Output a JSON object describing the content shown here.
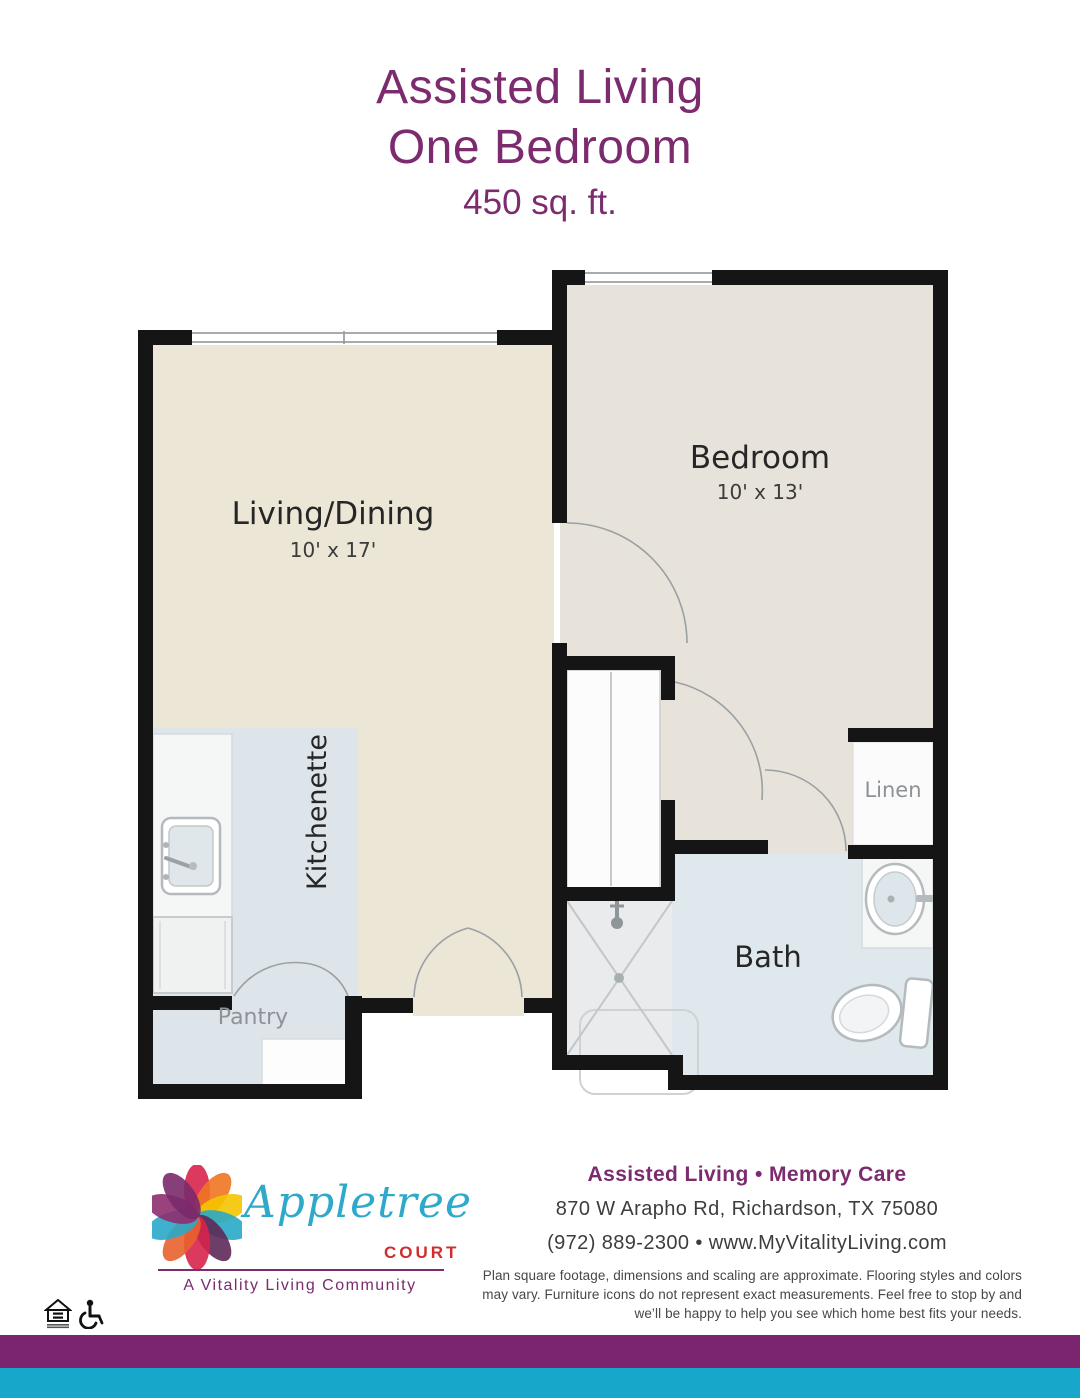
{
  "header": {
    "line1": "Assisted Living",
    "line2": "One Bedroom",
    "sqft": "450 sq. ft."
  },
  "rooms": {
    "living": {
      "label": "Living/Dining",
      "dims": "10' x 17'"
    },
    "bedroom": {
      "label": "Bedroom",
      "dims": "10' x 13'"
    },
    "kitchenette": {
      "label": "Kitchenette"
    },
    "pantry": {
      "label": "Pantry"
    },
    "bath": {
      "label": "Bath"
    },
    "linen": {
      "label": "Linen"
    }
  },
  "footer": {
    "brand": {
      "name": "Appletree",
      "suffix": "COURT",
      "tagline": "A Vitality Living Community"
    },
    "services": "Assisted Living • Memory Care",
    "address": "870 W Arapho Rd, Richardson, TX 75080",
    "phone_web": "(972) 889-2300 • www.MyVitalityLiving.com",
    "disclaimer": "Plan square footage, dimensions and scaling are approximate. Flooring styles and colors may vary. Furniture icons do not represent exact measurements. Feel free to stop by and we’ll be happy to help you see which home best fits your needs."
  },
  "colors": {
    "title_purple": "#7B2B6E",
    "purple_bar": "#7B2470",
    "teal_bar": "#17A7CB",
    "logo_teal": "#2FA9C9",
    "logo_red": "#D22D2D",
    "living_floor": "#EBE6D6",
    "bedroom_floor": "#E7E2DA",
    "kitchen_floor": "#DDE5EA",
    "bath_floor": "#DFE8ED"
  }
}
